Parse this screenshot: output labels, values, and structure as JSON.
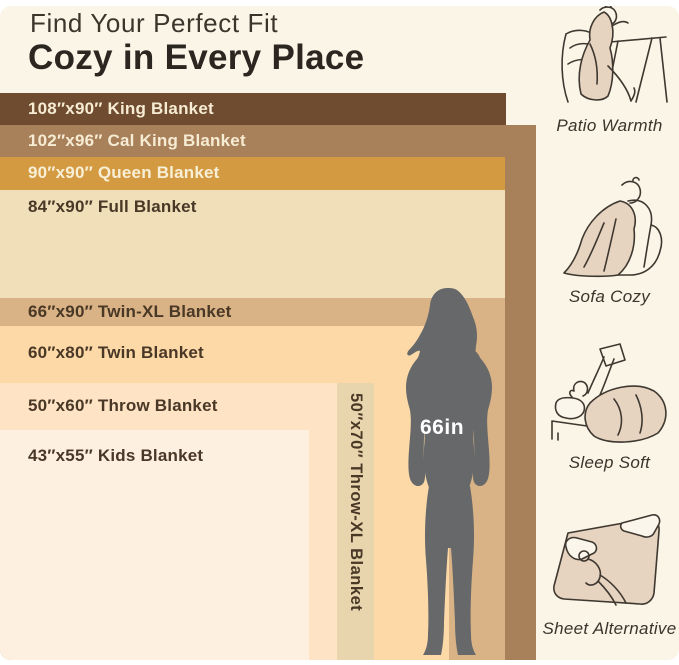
{
  "page": {
    "background": "#ffffff",
    "panel_background": "#faf5e6"
  },
  "header": {
    "kicker": "Find Your Perfect Fit",
    "title": "Cozy in Every Place",
    "kicker_color": "#3b352c",
    "title_color": "#2b2620"
  },
  "chart_data": {
    "type": "bar",
    "title": "Blanket size comparison chart with 66in person for scale",
    "unit": "inches",
    "baseline_px": 660,
    "legend_position": "none",
    "grid": false,
    "categories": [
      "King",
      "Cal King",
      "Queen",
      "Full",
      "Twin-XL",
      "Twin",
      "Throw-XL",
      "Throw",
      "Kids"
    ],
    "series": [
      {
        "name": "width_in",
        "values": [
          108,
          102,
          90,
          84,
          66,
          60,
          50,
          50,
          43
        ]
      },
      {
        "name": "length_in",
        "values": [
          90,
          96,
          90,
          90,
          90,
          80,
          70,
          60,
          55
        ]
      }
    ],
    "person": {
      "label": "66in",
      "height_in": 66,
      "color": "#67686a",
      "label_color": "#ffffff"
    },
    "blankets": [
      {
        "id": "king",
        "label": "108″x90″ King Blanket",
        "width_in": 108,
        "length_in": 90,
        "color": "#6f4c2f",
        "text_color": "#f6ebd3",
        "top": 93,
        "right": 506,
        "label_y": 109
      },
      {
        "id": "cal-king",
        "label": "102″x96″ Cal King Blanket",
        "width_in": 102,
        "length_in": 96,
        "color": "#a8805a",
        "text_color": "#f6ebd3",
        "top": 125,
        "right": 536,
        "label_y": 141
      },
      {
        "id": "queen",
        "label": "90″x90″ Queen Blanket",
        "width_in": 90,
        "length_in": 90,
        "color": "#d49a42",
        "text_color": "#f8efd7",
        "top": 157,
        "right": 505,
        "label_y": 173
      },
      {
        "id": "full",
        "label": "84″x90″ Full Blanket",
        "width_in": 84,
        "length_in": 90,
        "color": "#f1dfba",
        "text_color": "#4a3827",
        "top": 190,
        "right": 505,
        "label_y": 207
      },
      {
        "id": "twin-xl",
        "label": "66″x90″ Twin-XL Blanket",
        "width_in": 66,
        "length_in": 90,
        "color": "#d9b385",
        "text_color": "#4a3827",
        "top": 298,
        "right": 505,
        "label_y": 312
      },
      {
        "id": "twin",
        "label": "60″x80″ Twin Blanket",
        "width_in": 60,
        "length_in": 80,
        "color": "#fcd9a7",
        "text_color": "#4a3827",
        "top": 326,
        "right": 449,
        "label_y": 353
      },
      {
        "id": "throw-xl",
        "label": "50″x70″ Throw-XL Blanket",
        "width_in": 50,
        "length_in": 70,
        "color": "#e9d5ad",
        "text_color": "#4a3827",
        "top": 383,
        "right": 374,
        "vertical": true
      },
      {
        "id": "throw",
        "label": "50″x60″ Throw Blanket",
        "width_in": 50,
        "length_in": 60,
        "color": "#fee3c5",
        "text_color": "#4a3827",
        "top": 383,
        "right": 337,
        "label_y": 406
      },
      {
        "id": "kids",
        "label": "43″x55″ Kids Blanket",
        "width_in": 43,
        "length_in": 55,
        "color": "#fdf0e1",
        "text_color": "#4a3827",
        "top": 430,
        "right": 309,
        "label_y": 456
      }
    ]
  },
  "sidebar": {
    "text_color": "#3a342c",
    "items": [
      {
        "label": "Patio Warmth",
        "icon": "patio-warmth-illustration"
      },
      {
        "label": "Sofa Cozy",
        "icon": "sofa-cozy-illustration"
      },
      {
        "label": "Sleep Soft",
        "icon": "sleep-soft-illustration"
      },
      {
        "label": "Sheet Alternative",
        "icon": "sheet-alternative-illustration"
      }
    ]
  }
}
